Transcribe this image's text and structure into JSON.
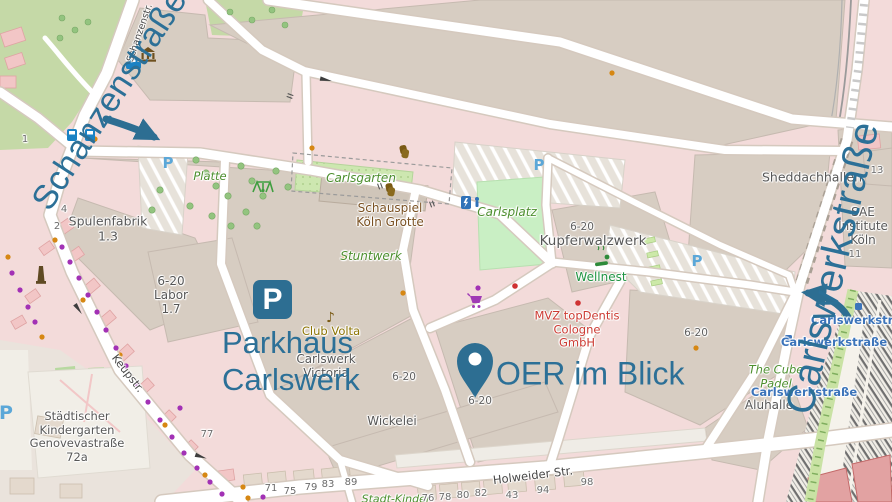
{
  "colors": {
    "annotation_blue": "#2c7097",
    "map_background": "#f3dbda",
    "building_beige": "#d7cdc2",
    "park_green": "#c5d9a7",
    "pitch_green": "#c9efc4",
    "transit_blue": "#3c74ba",
    "poi_red": "#cc3b33",
    "poi_purple": "#a231b5",
    "poi_orange": "#d68713"
  },
  "annotations": {
    "big_street_left": "Schanzenstraße",
    "big_street_right": "Carlswerkstraße",
    "parking_icon_letter": "P",
    "parking_line1": "Parkhaus",
    "parking_line2": "Carlswerk",
    "marker_label": "OER im Blick"
  },
  "street_names": {
    "schanzenstr_small": "Schanzenstr.",
    "keupstr": "Keupstr.",
    "holweider": "Holweider Str."
  },
  "place_labels": {
    "spulenfabrik": "Spulenfabrik\n1.3",
    "labor": "6-20\nLabor\n1.7",
    "kindergarten": "Städtischer\nKindergarten\nGenovevastraße\n72a",
    "schauspiel": "Schauspiel\nKöln Grotte",
    "club_volta": "Club Volta",
    "carlswerk_victoria": "Carlswerk\nVictoria",
    "wickelei": "Wickelei",
    "kupferwalzwerk": "Kupferwalzwerk",
    "wellnest": "Wellnest",
    "mvz_topdentis": "MVZ topDentis\nCologne\nGmbH",
    "sheddachhallen": "Sheddachhallen",
    "sae_institute": "SAE\nInstitute\nKöln",
    "aluhalle": "Aluhalle"
  },
  "area_labels": {
    "carlsgarten": "Carlsgarten",
    "carlsplatz": "Carlsplatz",
    "stuntwerk": "Stuntwerk",
    "platte": "Platte",
    "cube_padel": "The Cube\nPadel",
    "stadt_kinder": "Stadt-Kinder"
  },
  "transit_stop_name": "Carlswerkstraße",
  "house_numbers": [
    "1",
    "4",
    "2",
    "13",
    "11",
    "77",
    "71",
    "75",
    "79",
    "83",
    "89",
    "76",
    "78",
    "80",
    "82",
    "43",
    "94",
    "98"
  ],
  "unit_label": "6-20",
  "map_parking_letter": "P",
  "icon_glyphs": {
    "music_note": "♪"
  }
}
